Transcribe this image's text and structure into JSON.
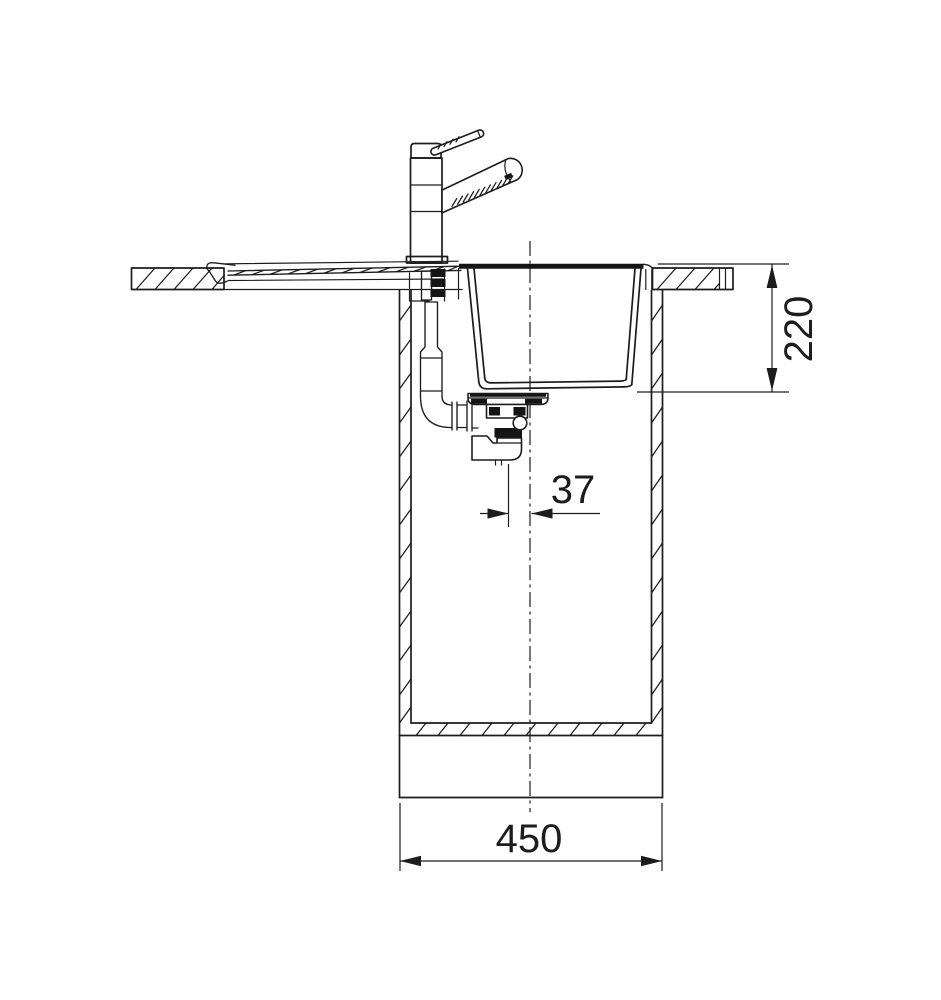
{
  "canvas": {
    "background": "#ffffff",
    "line_color": "#1c1c1c"
  },
  "diagram": {
    "dimensions": {
      "depth": {
        "label": "220"
      },
      "drain_offset": {
        "label": "37"
      },
      "cabinet_width": {
        "label": "450"
      }
    }
  }
}
